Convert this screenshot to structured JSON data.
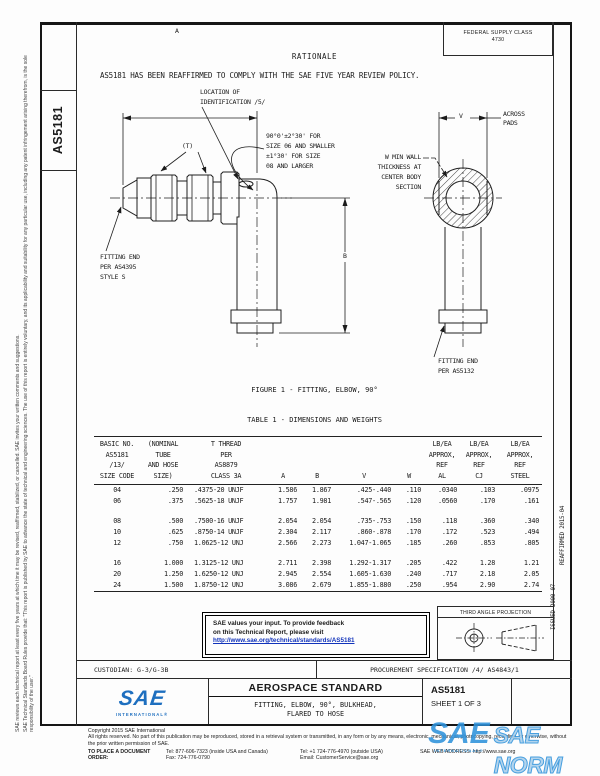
{
  "doc": {
    "number": "AS5181",
    "sheet": "SHEET 1 OF 3"
  },
  "left_margin": {
    "disclaimer1": "SAE Technical Standards Board Rules provide that: \"This report is published by SAE to advance the state of technical and engineering sciences. The use of this report is entirely voluntary, and its applicability and suitability for any particular use, including any patent infringement arising therefrom, is the sole responsibility of the user.\"",
    "disclaimer2": "SAE reviews each technical report at least every five years at which time it may be revised, reaffirmed, stabilized, or cancelled. SAE invites your written comments and suggestions."
  },
  "right_margin": {
    "issued": "ISSUED 2000-07",
    "reaffirmed": "REAFFIRMED 2015-04"
  },
  "fsc": {
    "label": "FEDERAL SUPPLY CLASS",
    "value": "4730"
  },
  "rationale": {
    "title": "RATIONALE",
    "body": "AS5181 HAS BEEN REAFFIRMED TO COMPLY WITH THE SAE FIVE YEAR REVIEW POLICY."
  },
  "figure": {
    "caption": "FIGURE 1 - FITTING, ELBOW, 90°",
    "location_note": "LOCATION OF\nIDENTIFICATION /5/",
    "angle_note": "90°0'±2°30' FOR\nSIZE 06 AND SMALLER\n±1°30' FOR SIZE\n08 AND LARGER",
    "t_label": "(T)",
    "dim_a": "A",
    "dim_b": "B",
    "dim_v": "V",
    "across_pads": "ACROSS\nPADS",
    "wall_note": "W MIN WALL\nTHICKNESS AT\nCENTER BODY\nSECTION",
    "end_left": "FITTING END\nPER AS4395\nSTYLE S",
    "end_right": "FITTING END\nPER AS5132"
  },
  "table": {
    "title": "TABLE 1 - DIMENSIONS AND WEIGHTS",
    "columns": [
      "BASIC NO.\nAS5181\n/13/\nSIZE CODE",
      "(NOMINAL\nTUBE\nAND HOSE\nSIZE)",
      "T THREAD\nPER\nAS8879\nCLASS 3A",
      "A",
      "B",
      "V",
      "W",
      "LB/EA\nAPPROX,\nREF\nAL",
      "LB/EA\nAPPROX,\nREF\nCJ",
      "LB/EA\nAPPROX,\nREF\nSTEEL"
    ],
    "rows": [
      [
        "04",
        ".250",
        ".4375-20 UNJF",
        "1.586",
        "1.867",
        ".425-.440",
        ".110",
        ".0340",
        ".103",
        ".0975"
      ],
      [
        "06",
        ".375",
        ".5625-18 UNJF",
        "1.757",
        "1.981",
        ".547-.565",
        ".120",
        ".0560",
        ".170",
        ".161"
      ],
      [
        "08",
        ".500",
        ".7500-16 UNJF",
        "2.054",
        "2.054",
        ".735-.753",
        ".150",
        ".118",
        ".360",
        ".340"
      ],
      [
        "10",
        ".625",
        ".8750-14 UNJF",
        "2.304",
        "2.117",
        ".860-.878",
        ".170",
        ".172",
        ".523",
        ".494"
      ],
      [
        "12",
        ".750",
        "1.0625-12 UNJ",
        "2.566",
        "2.273",
        "1.047-1.065",
        ".185",
        ".260",
        ".853",
        ".805"
      ],
      [
        "16",
        "1.000",
        "1.3125-12 UNJ",
        "2.711",
        "2.398",
        "1.292-1.317",
        ".205",
        ".422",
        "1.28",
        "1.21"
      ],
      [
        "20",
        "1.250",
        "1.6250-12 UNJ",
        "2.945",
        "2.554",
        "1.605-1.630",
        ".240",
        ".717",
        "2.18",
        "2.05"
      ],
      [
        "24",
        "1.500",
        "1.8750-12 UNJ",
        "3.086",
        "2.679",
        "1.855-1.880",
        ".250",
        ".954",
        "2.90",
        "2.74"
      ]
    ]
  },
  "feedback": {
    "line1": "SAE values your input. To provide feedback",
    "line2": "on this Technical Report, please visit",
    "url": "http://www.sae.org/technical/standards/AS5181"
  },
  "projection": {
    "label": "THIRD ANGLE PROJECTION"
  },
  "title_block": {
    "custodian": "CUSTODIAN: G-3/G-3B",
    "procurement": "PROCUREMENT SPECIFICATION /4/ AS4843/1",
    "logo": "SAE",
    "logo_sub": "INTERNATIONAL®",
    "heading": "AEROSPACE STANDARD",
    "title": "FITTING, ELBOW, 90°, BULKHEAD,\nFLARED TO HOSE"
  },
  "footer": {
    "copyright": "Copyright 2015 SAE International",
    "rights": "All rights reserved. No part of this publication may be reproduced, stored in a retrieval system or transmitted, in any form or by any means, electronic, mechanical, photocopying, recording, or otherwise, without the prior written permission of SAE.",
    "order_label": "TO PLACE A DOCUMENT ORDER:",
    "tel_inside": "Tel: 877-606-7323 (inside USA and Canada)",
    "fax": "Fax: 724-776-0790",
    "tel_outside": "Tel: +1 724-776-4970 (outside USA)",
    "email": "Email: CustomerService@sae.org",
    "web": "SAE WEB ADDRESS: http://www.sae.org"
  },
  "watermark": {
    "logo": "SAE",
    "sub": "INTERNATIONAL®",
    "text": "SAE NORM"
  },
  "colors": {
    "accent_blue": "#1e6fbf",
    "watermark_blue": "#2f93dc",
    "link_blue": "#1133bb"
  }
}
